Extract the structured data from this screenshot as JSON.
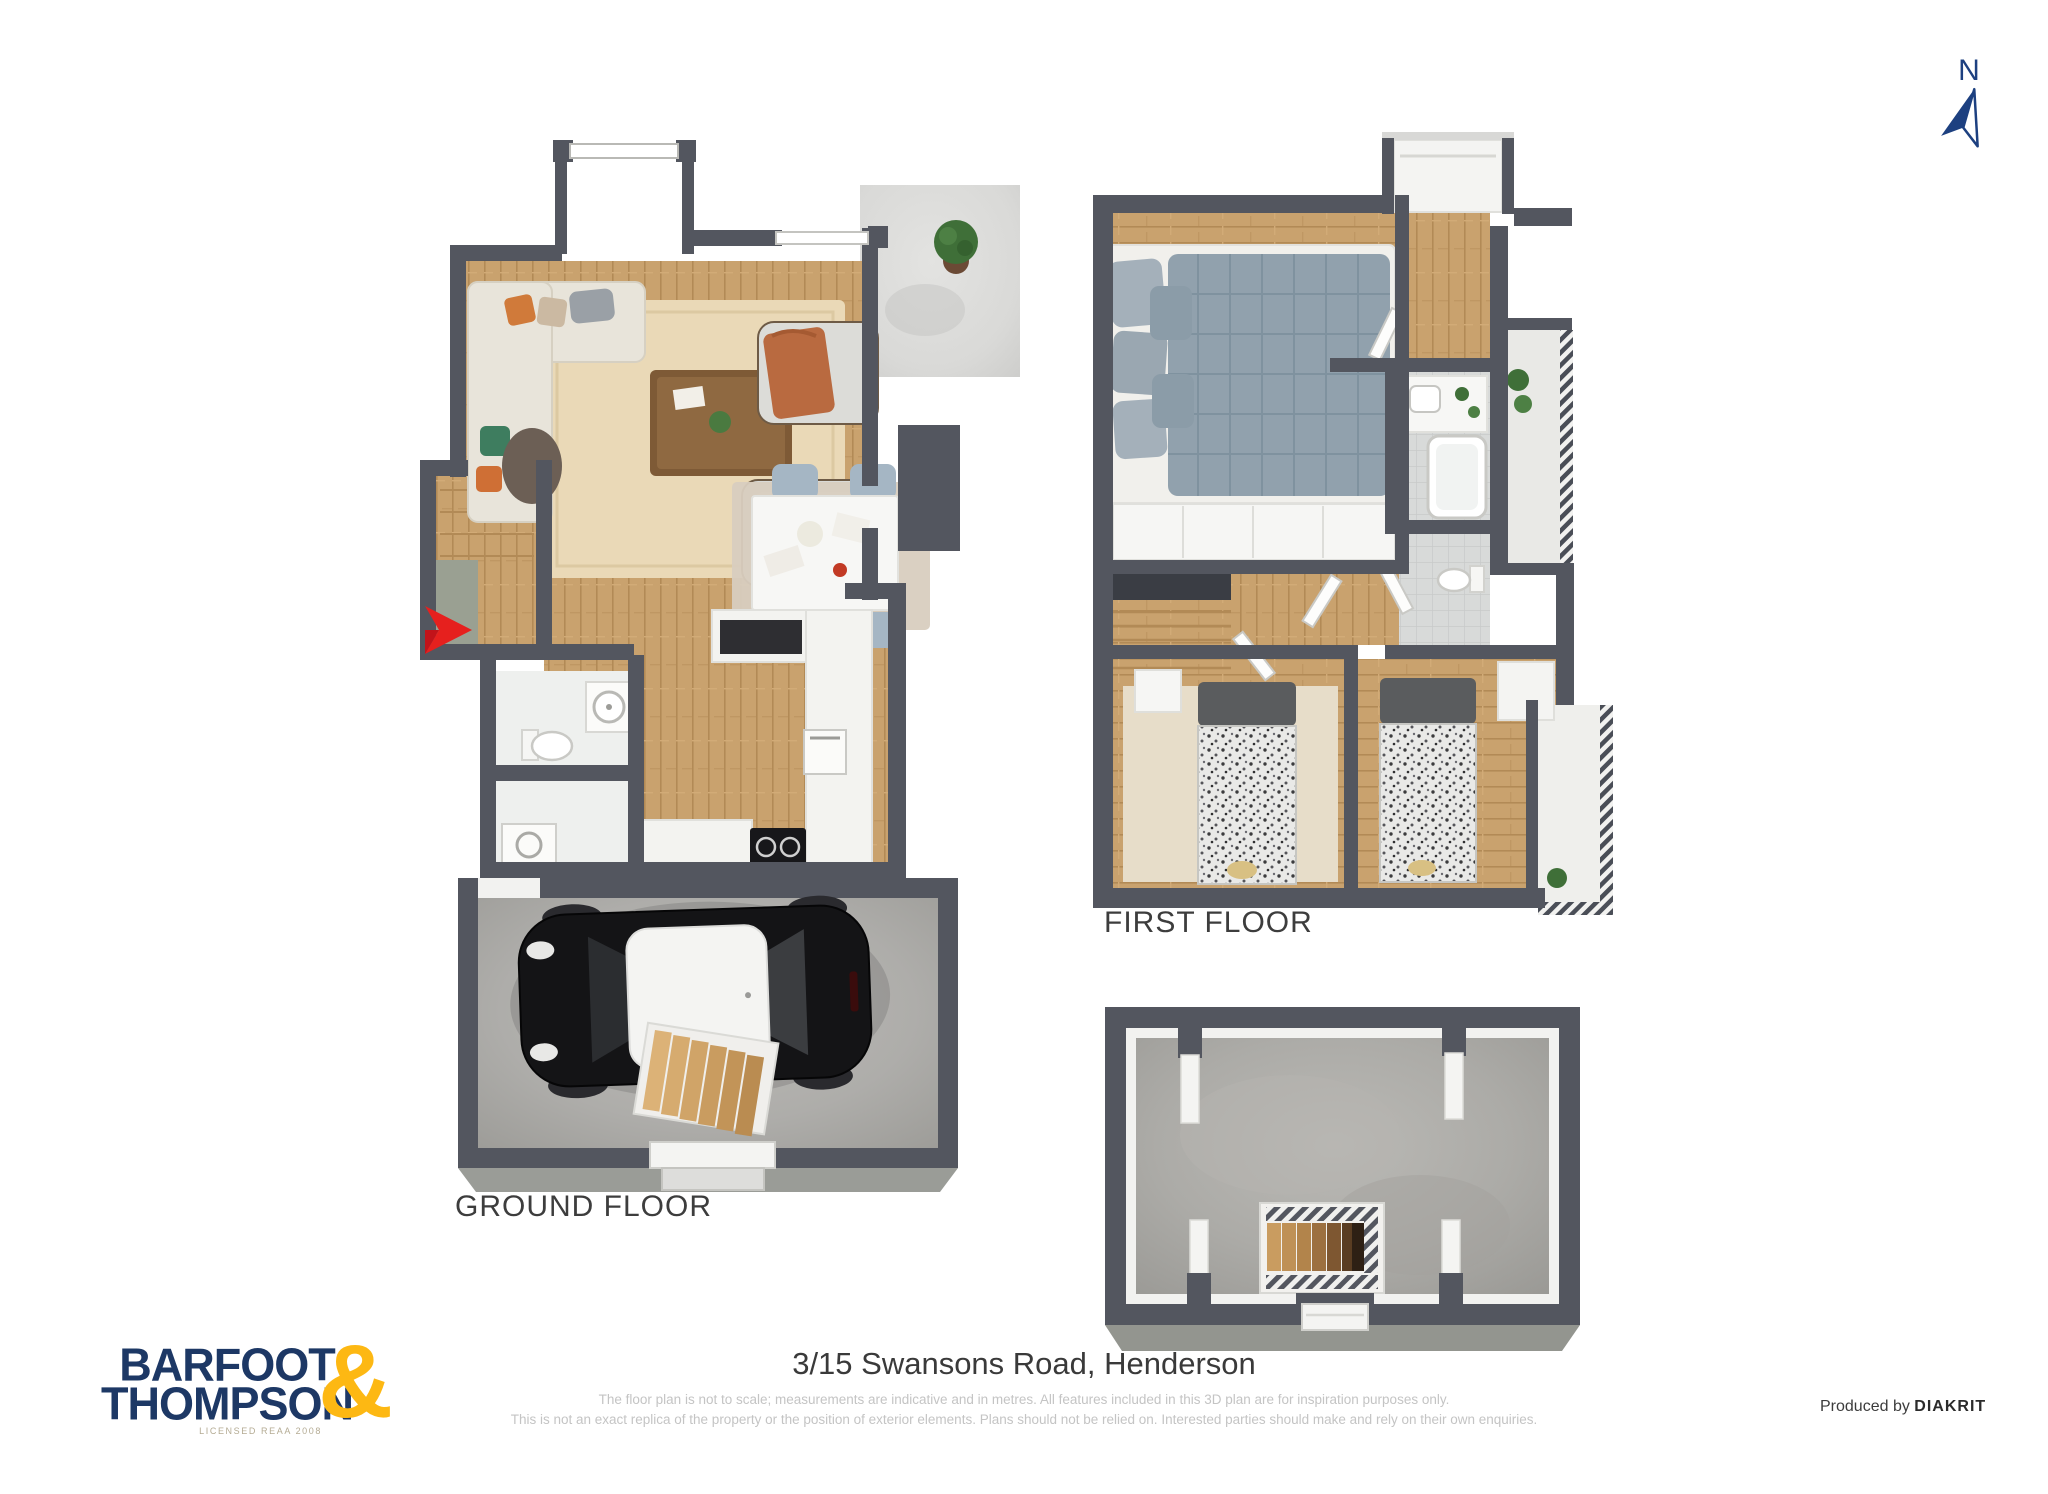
{
  "compass": {
    "label": "N",
    "color": "#1d4080"
  },
  "plans": {
    "ground_floor": {
      "label": "GROUND FLOOR"
    },
    "first_floor": {
      "label": "FIRST FLOOR"
    },
    "basement": {
      "label": ""
    }
  },
  "entry_marker": {
    "color": "#e6201e"
  },
  "footer": {
    "logo": {
      "line1": "BARFOOT",
      "line2": "THOMPSON",
      "ampersand": "&",
      "tagline": "LICENSED REAA 2008",
      "navy": "#1d3865",
      "gold": "#fdb813"
    },
    "address": "3/15 Swansons Road, Henderson",
    "disclaimer_line1": "The floor plan is not to scale; measurements are indicative and in metres. All features included in this 3D plan are for inspiration purposes only.",
    "disclaimer_line2": "This is not an exact replica of the property or the position of exterior elements. Plans should not be relied on. Interested parties should make and rely on their own enquiries.",
    "produced_by": "Produced by ",
    "producer": "DIAKRIT"
  },
  "colors": {
    "wall": "#53565f",
    "wall_base": "#9a9c97",
    "wood_floor": "#c9a26e",
    "concrete_floor": "#aeadaa",
    "patio_tile": "#dcdcda",
    "rug_cream": "#ead9b7",
    "duvet_blue": "#91a1ad",
    "chair_blue": "#a5b6c4",
    "label_gray": "#3d3d3d",
    "disclaimer_gray": "#c4c4c4"
  }
}
